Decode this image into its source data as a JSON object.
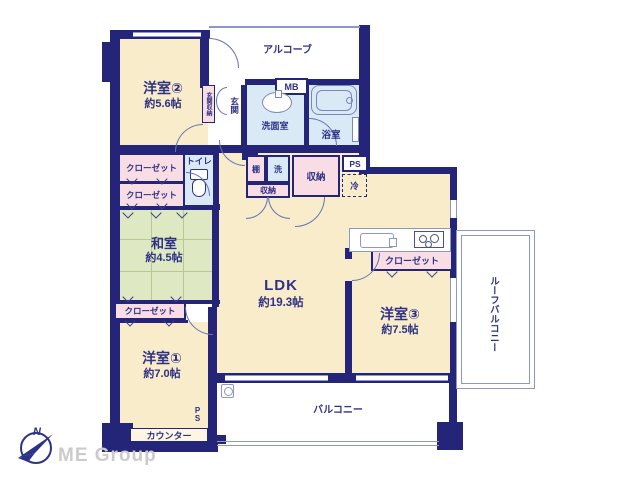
{
  "colors": {
    "wall": "#242579",
    "room_cream": "#f8ecca",
    "tatami_green": "#dee8c2",
    "closet_pink": "#f8dde4",
    "wet_blue": "#d9e9f6",
    "outline_periwinkle": "#8e97c9",
    "text_navy": "#2e3185",
    "logo_gray": "#cbcbcb"
  },
  "rooms": {
    "yoshitsu2": {
      "name": "洋室②",
      "size": "約5.6帖"
    },
    "washitsu": {
      "name": "和室",
      "size": "約4.5帖"
    },
    "yoshitsu1": {
      "name": "洋室①",
      "size": "約7.0帖"
    },
    "ldk": {
      "name": "LDK",
      "size": "約19.3帖"
    },
    "yoshitsu3": {
      "name": "洋室③",
      "size": "約7.5帖"
    }
  },
  "labels": {
    "alcove": "アルコーブ",
    "mb": "MB",
    "genkan": "玄関",
    "genkan_storage": "玄関収納",
    "senmenshitsu": "洗面室",
    "yokushitsu": "浴室",
    "toilet": "トイレ",
    "closet": "クローゼット",
    "tana": "棚",
    "sen": "洗",
    "shuno": "収納",
    "ps": "PS",
    "rei": "冷",
    "counter": "カウンター",
    "balcony": "バルコニー",
    "roof_balcony": "ルーフバルコニー"
  },
  "logo": {
    "company": "ME Group",
    "compass_n": "N"
  }
}
